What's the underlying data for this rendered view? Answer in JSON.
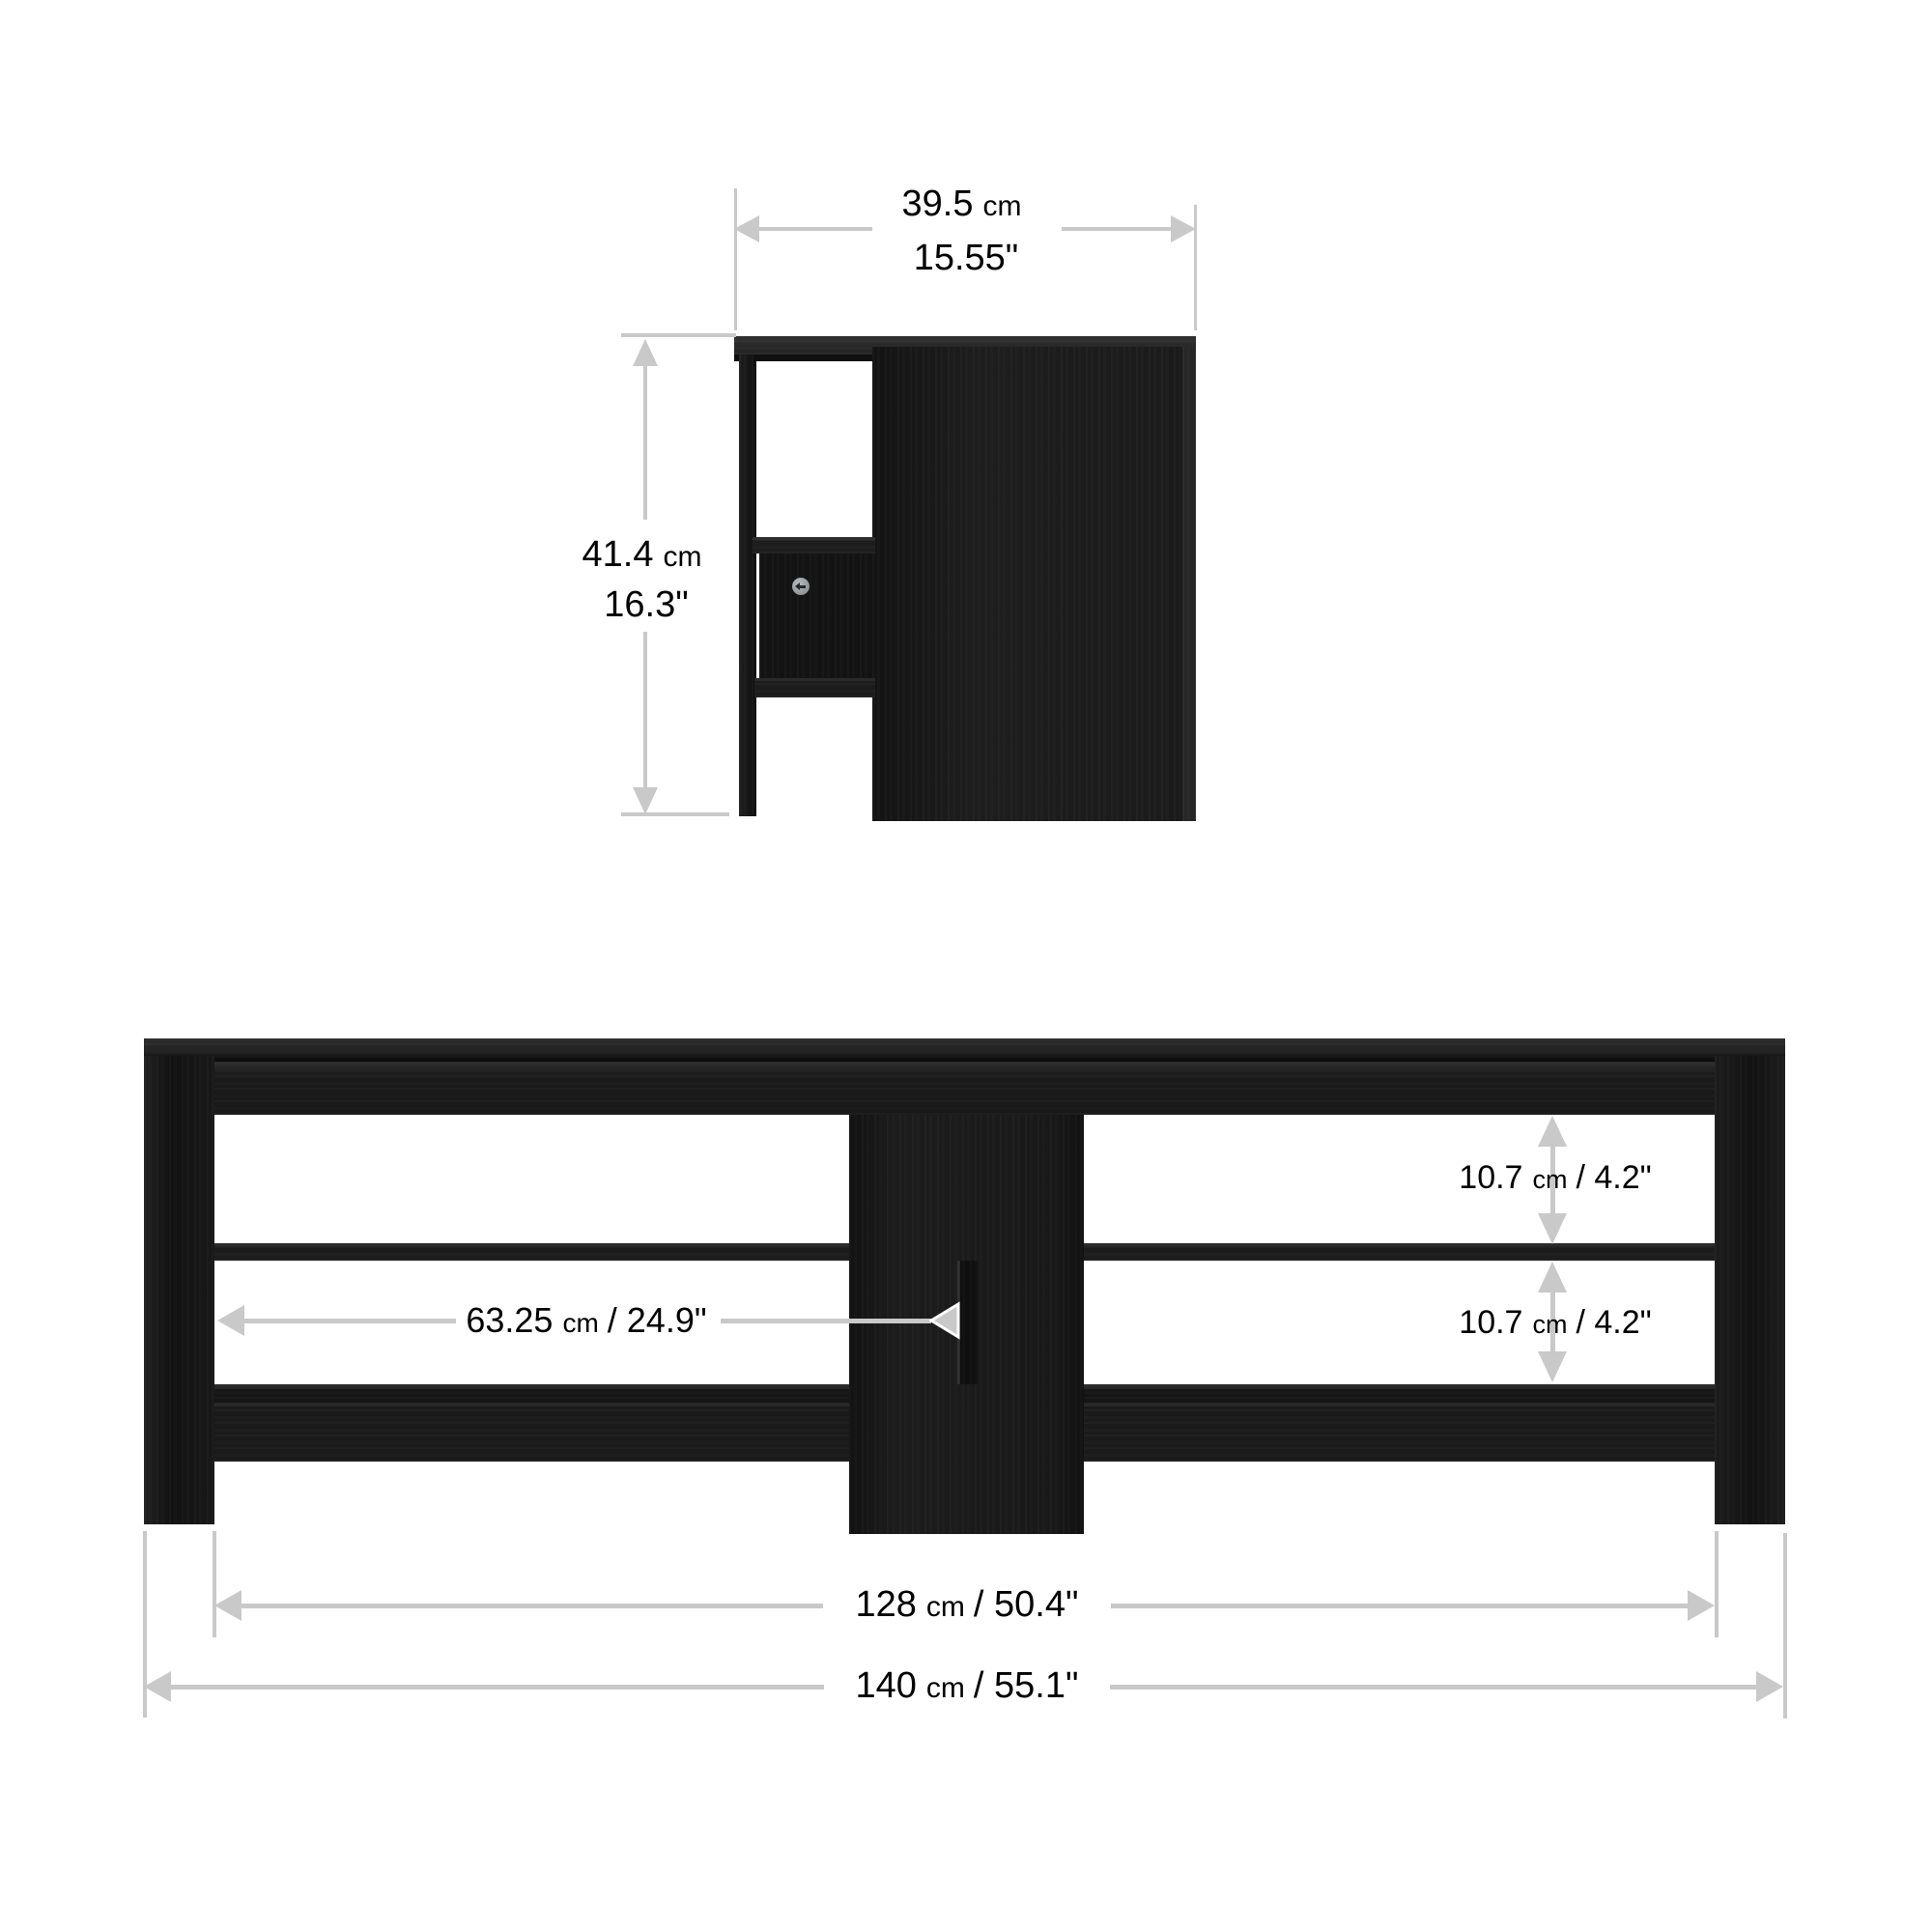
{
  "colors": {
    "background": "#ffffff",
    "furniture_black": "#1a1a1a",
    "dimension_gray": "#c9c9c9",
    "label_text": "#000000"
  },
  "icons": {
    "screw": "screw-icon (gray circle with left arrow)",
    "dimension_arrows": "gray triangle arrowheads"
  },
  "side_view": {
    "width_dim": {
      "num": "39.5",
      "unit": "cm",
      "inches": "15.55\""
    },
    "height_dim": {
      "num": "41.4",
      "unit": "cm",
      "inches": "16.3\""
    }
  },
  "front_view": {
    "gap_top_dim": {
      "num": "10.7",
      "unit": "cm",
      "rest": "/ 4.2\""
    },
    "gap_bottom_dim": {
      "num": "10.7",
      "unit": "cm",
      "rest": "/ 4.2\""
    },
    "center_dim": {
      "num": "63.25",
      "unit": "cm",
      "rest": "/ 24.9\""
    },
    "shelf_span_dim": {
      "num": "128",
      "unit": "cm",
      "rest": "/ 50.4\""
    },
    "overall_width_dim": {
      "num": "140",
      "unit": "cm",
      "rest": "/ 55.1\""
    }
  }
}
